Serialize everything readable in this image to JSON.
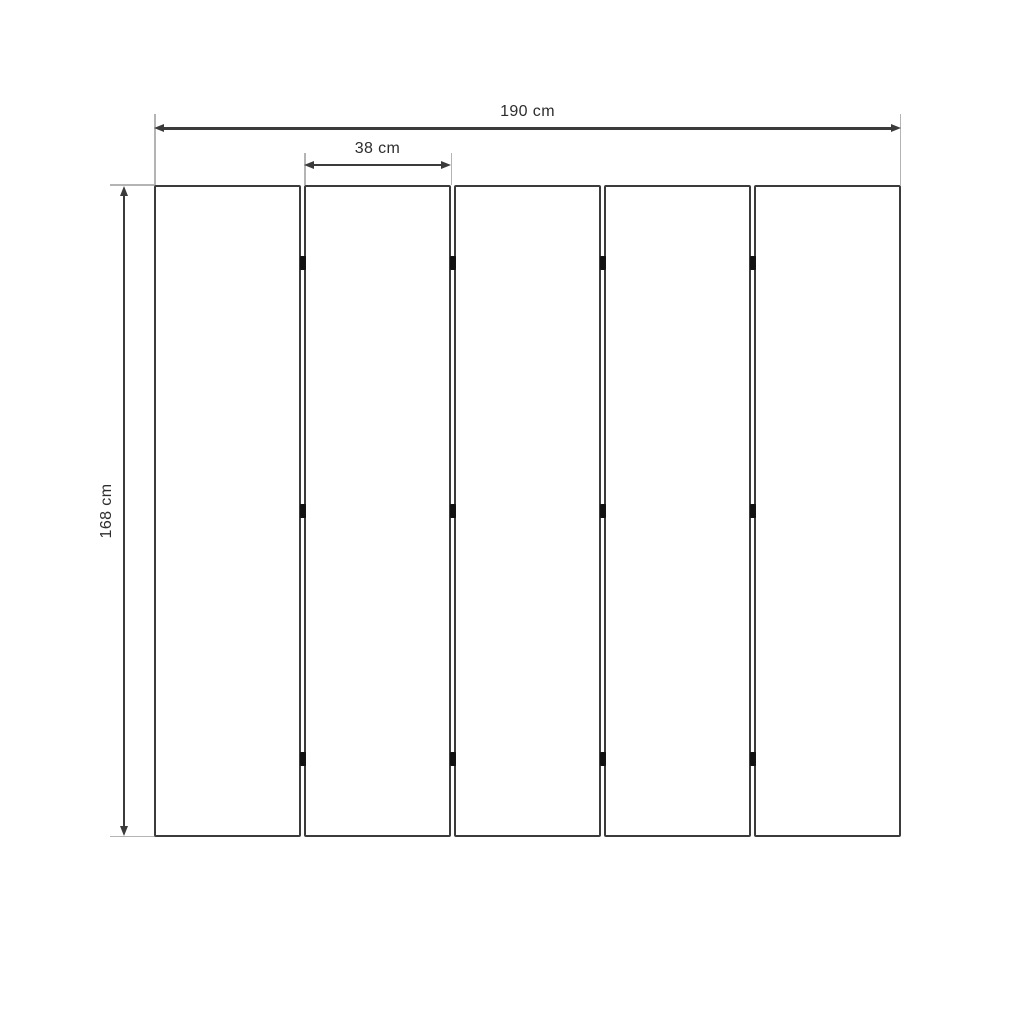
{
  "diagram": {
    "panel_count": 5,
    "hinge_gaps": 4,
    "hinge_rows": 3,
    "hinge_row_percents": [
      12,
      50,
      88
    ]
  },
  "dimensions": {
    "overall_width": {
      "label": "190 cm",
      "value": 190,
      "unit": "cm"
    },
    "panel_width": {
      "label": "38 cm",
      "value": 38,
      "unit": "cm"
    },
    "height": {
      "label": "168 cm",
      "value": 168,
      "unit": "cm"
    }
  },
  "colors": {
    "background": "#ffffff",
    "panel_fill": "#ffffff",
    "panel_border": "#3b3b3b",
    "dimension_line": "#3b3b3b",
    "extension_line": "#b4b4b4",
    "hinge": "#121212",
    "text": "#2d2d2d"
  }
}
